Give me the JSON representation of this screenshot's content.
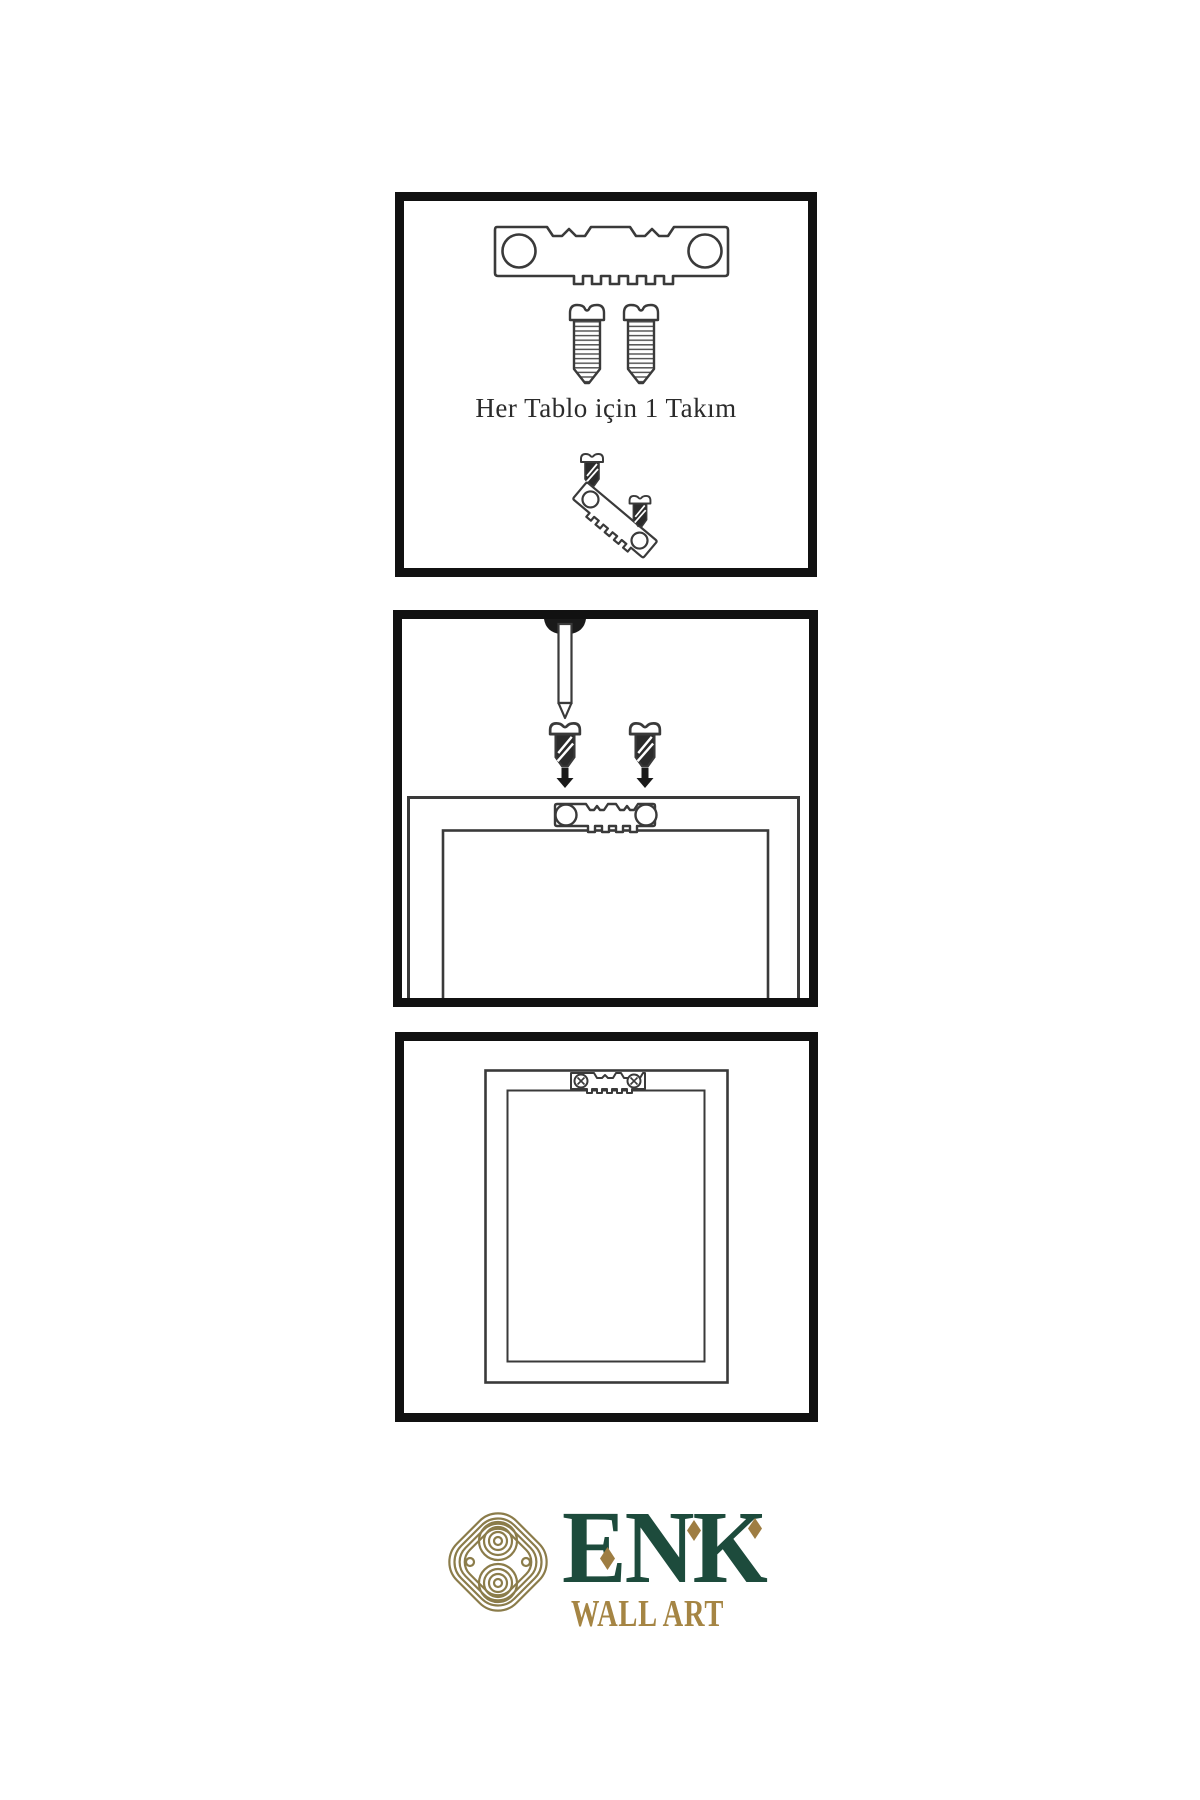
{
  "step1": {
    "caption": "Her Tablo için 1 Takım"
  },
  "logo": {
    "brand": "ENK",
    "tagline": "WALL ART"
  },
  "icons": {
    "step1": [
      "sawtooth-hanger-icon",
      "screw-icon",
      "screw-icon",
      "small-screw-icon",
      "tilted-sawtooth-hanger-icon",
      "small-screw-icon"
    ],
    "step2": [
      "wall-nail-icon",
      "dark-screw-icon",
      "dark-screw-icon",
      "arrow-down-icon",
      "arrow-down-icon",
      "frame-back-icon",
      "sawtooth-hanger-icon"
    ],
    "step3": [
      "frame-back-icon",
      "mounted-sawtooth-hanger-icon"
    ],
    "logo": [
      "knot-logo-icon",
      "diamond-accent",
      "diamond-accent",
      "diamond-accent"
    ]
  },
  "colors": {
    "background": "#ffffff",
    "panel_border": "#111111",
    "line_art": "#3a3a3a",
    "screw_dark": "#2b2b2b",
    "arrow_black": "#1a1a1a",
    "brand_green": "#1d4b3c",
    "brand_gold": "#a58544",
    "accent_gold": "#9e7d42",
    "knot_gold": "#8b7c4a",
    "caption_text": "#2b2b2b"
  }
}
